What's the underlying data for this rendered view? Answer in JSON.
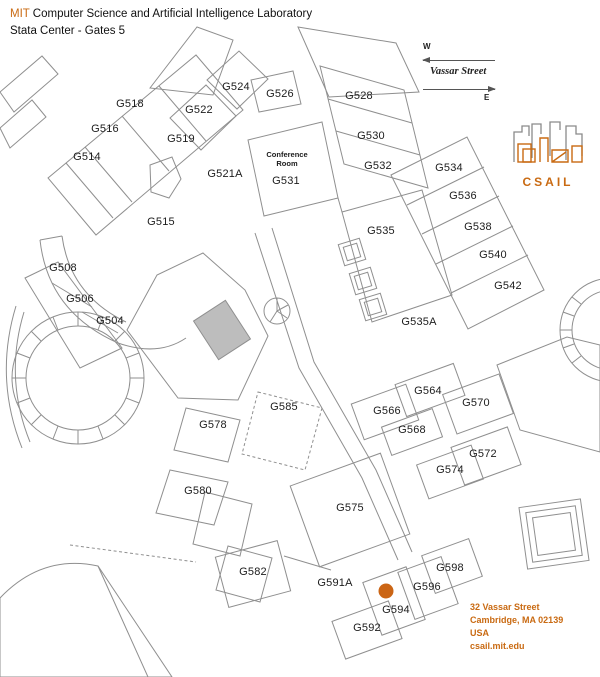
{
  "header": {
    "org_prefix": "MIT",
    "org_rest": " Computer Science and Artificial Intelligence Laboratory",
    "subtitle": "Stata Center - Gates 5"
  },
  "compass": {
    "west": "W",
    "east": "E",
    "street": "Vassar Street"
  },
  "logo": {
    "text": "CSAIL"
  },
  "address": {
    "line1": "32 Vassar Street",
    "line2": "Cambridge, MA 02139",
    "line3": "USA",
    "line4": "csail.mit.edu"
  },
  "colors": {
    "accent": "#C96A12",
    "marker": "#CB6515",
    "wall": "#8f8f8f"
  },
  "marker": {
    "room": "G594",
    "x": 386,
    "y": 591
  },
  "conference_room": {
    "line1": "Conference",
    "line2": "Room",
    "room": "G531"
  },
  "rooms": [
    {
      "id": "G518",
      "x": 130,
      "y": 104
    },
    {
      "id": "G516",
      "x": 105,
      "y": 129
    },
    {
      "id": "G514",
      "x": 87,
      "y": 157
    },
    {
      "id": "G522",
      "x": 199,
      "y": 110
    },
    {
      "id": "G524",
      "x": 236,
      "y": 87
    },
    {
      "id": "G526",
      "x": 280,
      "y": 94
    },
    {
      "id": "G519",
      "x": 181,
      "y": 139
    },
    {
      "id": "G521A",
      "x": 225,
      "y": 174
    },
    {
      "id": "G515",
      "x": 161,
      "y": 222
    },
    {
      "id": "G528",
      "x": 359,
      "y": 96
    },
    {
      "id": "G530",
      "x": 371,
      "y": 136
    },
    {
      "id": "G532",
      "x": 378,
      "y": 166
    },
    {
      "id": "G531",
      "x": 286,
      "y": 181
    },
    {
      "id": "G534",
      "x": 449,
      "y": 168
    },
    {
      "id": "G536",
      "x": 463,
      "y": 196
    },
    {
      "id": "G538",
      "x": 478,
      "y": 227
    },
    {
      "id": "G540",
      "x": 493,
      "y": 255
    },
    {
      "id": "G542",
      "x": 508,
      "y": 286
    },
    {
      "id": "G535",
      "x": 381,
      "y": 231
    },
    {
      "id": "G535A",
      "x": 419,
      "y": 322
    },
    {
      "id": "G508",
      "x": 63,
      "y": 268
    },
    {
      "id": "G506",
      "x": 80,
      "y": 299
    },
    {
      "id": "G504",
      "x": 110,
      "y": 321
    },
    {
      "id": "G585",
      "x": 284,
      "y": 407
    },
    {
      "id": "G564",
      "x": 428,
      "y": 391
    },
    {
      "id": "G566",
      "x": 387,
      "y": 411
    },
    {
      "id": "G568",
      "x": 412,
      "y": 430
    },
    {
      "id": "G570",
      "x": 476,
      "y": 403
    },
    {
      "id": "G572",
      "x": 483,
      "y": 454
    },
    {
      "id": "G574",
      "x": 450,
      "y": 470
    },
    {
      "id": "G578",
      "x": 213,
      "y": 425
    },
    {
      "id": "G580",
      "x": 198,
      "y": 491
    },
    {
      "id": "G575",
      "x": 350,
      "y": 508
    },
    {
      "id": "G582",
      "x": 253,
      "y": 572
    },
    {
      "id": "G591A",
      "x": 335,
      "y": 583
    },
    {
      "id": "G598",
      "x": 450,
      "y": 568
    },
    {
      "id": "G596",
      "x": 427,
      "y": 587
    },
    {
      "id": "G594",
      "x": 396,
      "y": 610
    },
    {
      "id": "G592",
      "x": 367,
      "y": 628
    }
  ]
}
